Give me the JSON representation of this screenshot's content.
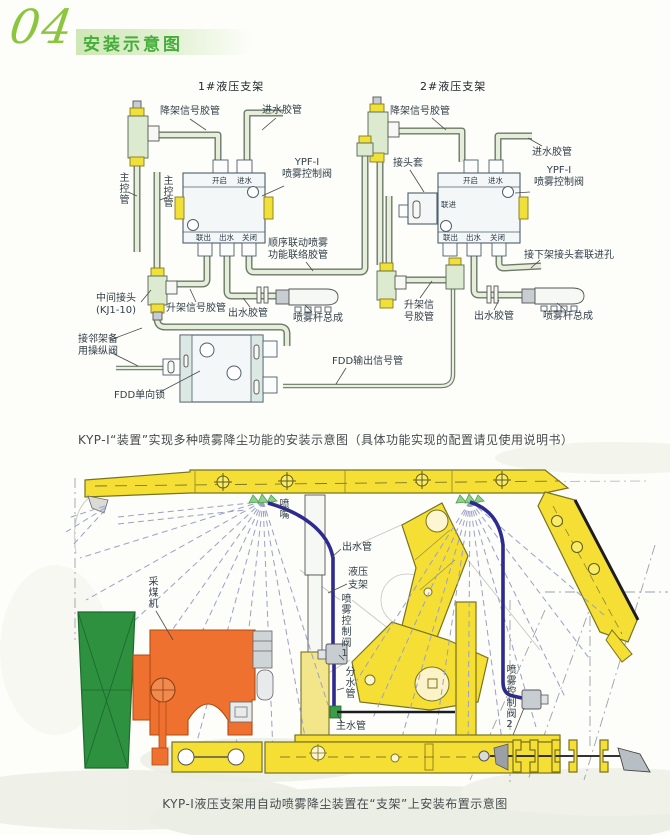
{
  "page": {
    "number": "04",
    "title": "安装示意图"
  },
  "colors": {
    "header_green": "#45ad3a",
    "header_script_green": "#8cc63f",
    "pipe_fill": "#e6edda",
    "pipe_outline": "#6b7a68",
    "valve_yellow": "#f0e03a",
    "support_yellow": "#f6df35",
    "shearer_orange": "#ee7130",
    "drum_green": "#2e9140",
    "water_pipe_blue": "#2e2a8e",
    "spray_dash_blue": "#9aa0c8"
  },
  "top_diagram": {
    "support1_title": "1#液压支架",
    "support2_title": "2#液压支架",
    "caption": "KYP-I“装置”实现多种喷雾降尘功能的安装示意图（具体功能实现的配置请见使用说明书）",
    "labels": {
      "lower_signal_hose": "降架信号胶管",
      "inlet_hose": "进水胶管",
      "ypf_model": "YPF-Ⅰ",
      "ypf_name": "喷雾控制阀",
      "main_control_pipe": "主控管",
      "port_open": "开启",
      "port_water_in": "进水",
      "port_link_out": "联出",
      "port_water_out": "出水",
      "port_close": "关闭",
      "port_link_in": "联进",
      "joint_sleeve": "接头套",
      "sequence_hose_line1": "顺序联动喷雾",
      "sequence_hose_line2": "功能联络胶管",
      "middle_joint_line1": "中间接头",
      "middle_joint_line2": "(KJ1-10)",
      "raise_signal_hose": "升架信号胶管",
      "raise_signal_hose2_line1": "升架信",
      "raise_signal_hose2_line2": "号胶管",
      "outlet_hose": "出水胶管",
      "spray_bar_assembly": "喷雾杆总成",
      "adjacent_valve_line1": "接邻架备",
      "adjacent_valve_line2": "用操纵阀",
      "fdd_lock": "FDD单向锁",
      "fdd_output_pipe": "FDD输出信号管",
      "next_frame_hole": "接下架接头套联进孔"
    }
  },
  "bottom_diagram": {
    "caption": "KYP-I液压支架用自动喷雾降尘装置在“支架”上安装布置示意图",
    "labels": {
      "nozzle": "喷嘴",
      "outlet_pipe": "出水管",
      "support_line1": "液压",
      "support_line2": "支架",
      "spray_valve_1": "喷雾控制阀1",
      "distribution_pipe": "分水管",
      "main_water_pipe": "主水管",
      "spray_valve_2": "喷雾控制阀2",
      "shearer": "采煤机"
    }
  }
}
